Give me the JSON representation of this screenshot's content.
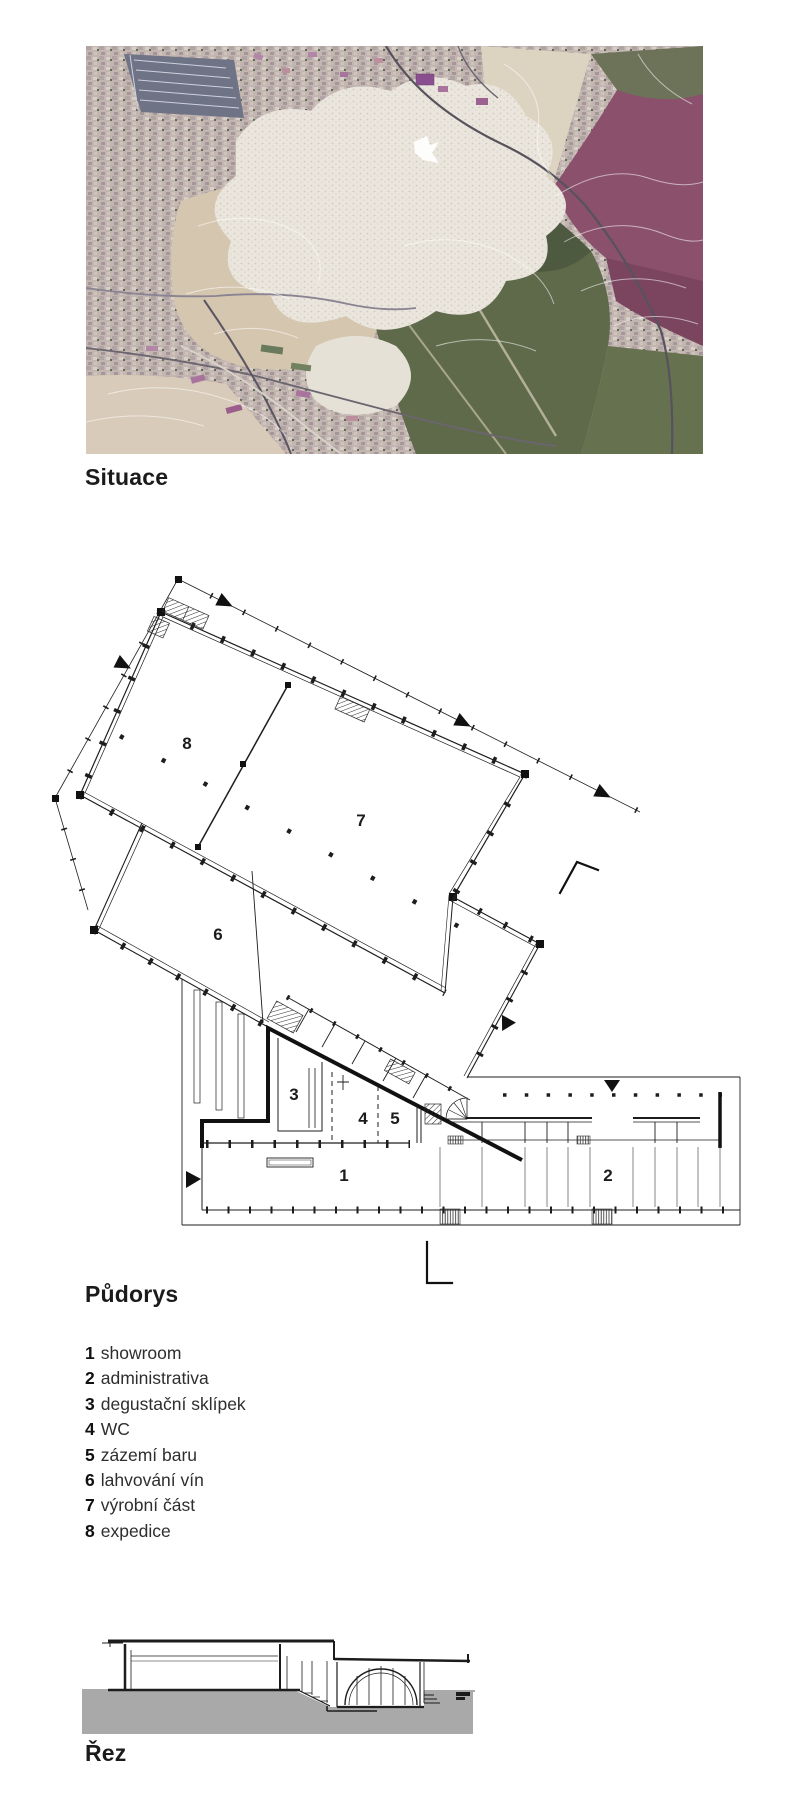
{
  "headings": {
    "situace": "Situace",
    "pudorys": "Půdorys",
    "rez": "Řez"
  },
  "legend": {
    "items": [
      {
        "num": "1",
        "label": "showroom"
      },
      {
        "num": "2",
        "label": "administrativa"
      },
      {
        "num": "3",
        "label": "degustační sklípek"
      },
      {
        "num": "4",
        "label": "WC"
      },
      {
        "num": "5",
        "label": "zázemí baru"
      },
      {
        "num": "6",
        "label": "lahvování vín"
      },
      {
        "num": "7",
        "label": "výrobní část"
      },
      {
        "num": "8",
        "label": "expedice"
      }
    ]
  },
  "plan": {
    "room_numbers": [
      "1",
      "2",
      "3",
      "4",
      "5",
      "6",
      "7",
      "8"
    ]
  },
  "colors": {
    "ink": "#1d1d1d",
    "ground_gray": "#a9a9a9",
    "aerial_base": "#c6bab3",
    "aerial_magenta": "#8a506c",
    "aerial_green": "#5e6a4a",
    "aerial_beige": "#d5c6b0",
    "aerial_white_blob": "#eae6dd"
  }
}
